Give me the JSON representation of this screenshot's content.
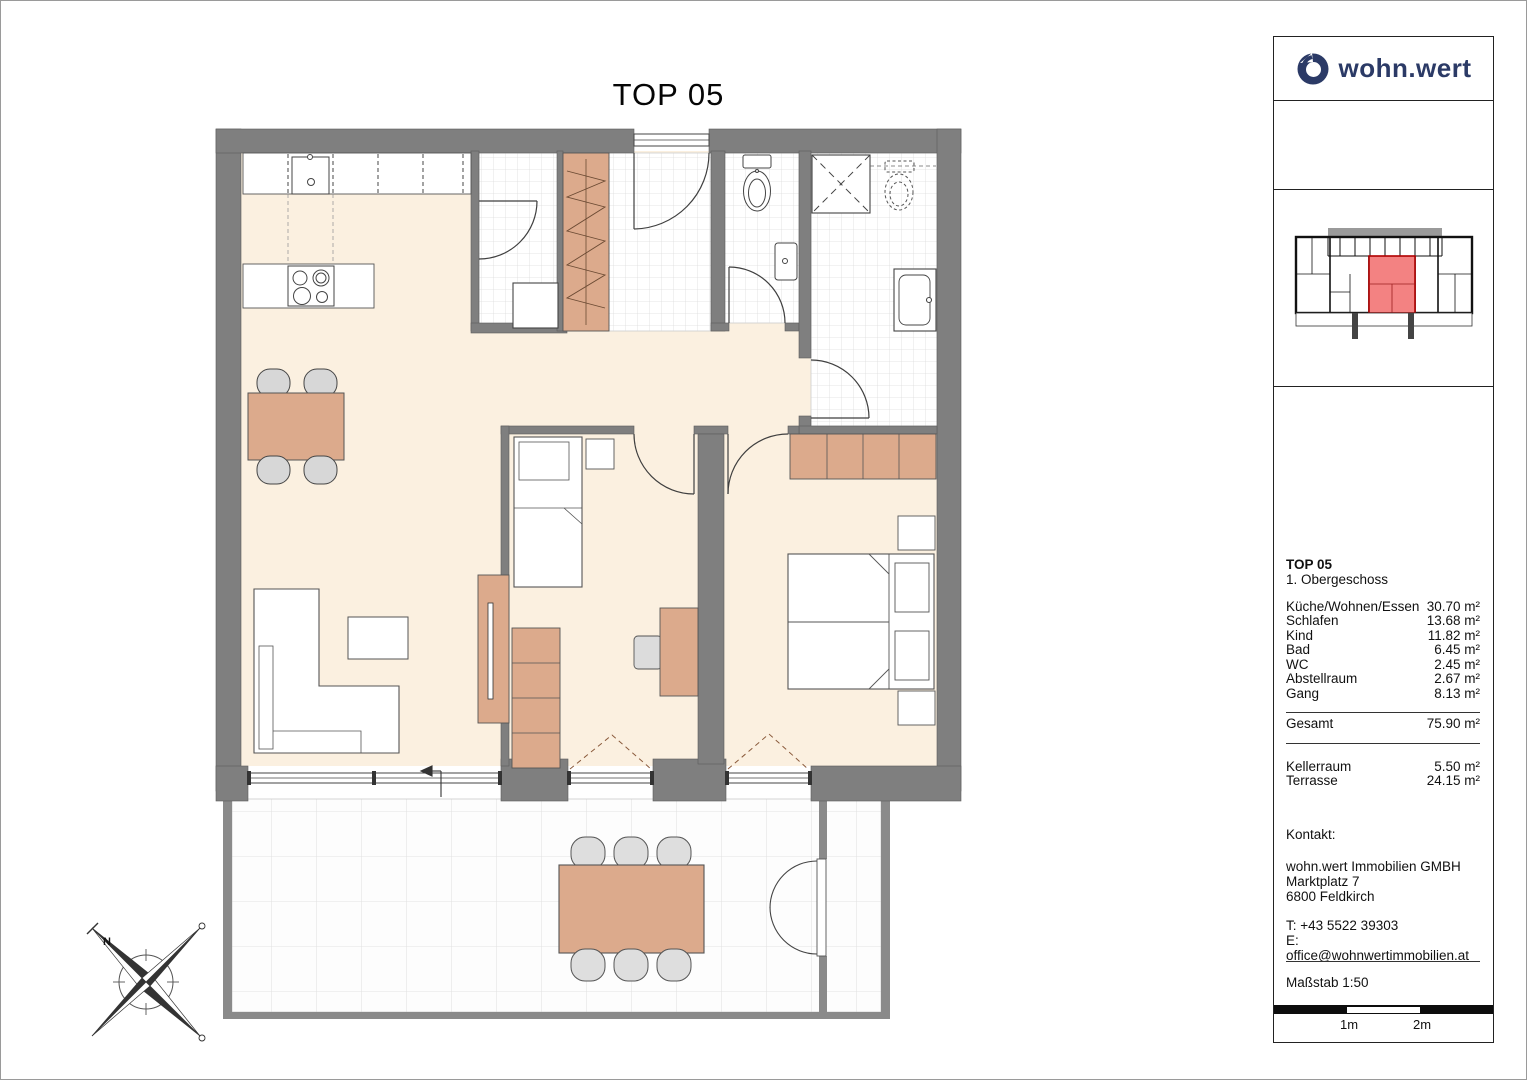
{
  "page": {
    "title": "TOP 05"
  },
  "sidebar": {
    "logo_text": "wohn.wert",
    "unit": {
      "title": "TOP 05",
      "floor": "1. Obergeschoss"
    },
    "rooms": [
      {
        "label": "Küche/Wohnen/Essen",
        "area": "30.70 m²"
      },
      {
        "label": "Schlafen",
        "area": "13.68 m²"
      },
      {
        "label": "Kind",
        "area": "11.82 m²"
      },
      {
        "label": "Bad",
        "area": "6.45 m²"
      },
      {
        "label": "WC",
        "area": "2.45 m²"
      },
      {
        "label": "Abstellraum",
        "area": "2.67 m²"
      },
      {
        "label": "Gang",
        "area": "8.13 m²"
      }
    ],
    "total": {
      "label": "Gesamt",
      "area": "75.90 m²"
    },
    "extras": [
      {
        "label": "Kellerraum",
        "area": "5.50 m²"
      },
      {
        "label": "Terrasse",
        "area": "24.15 m²"
      }
    ],
    "contact": {
      "heading": "Kontakt:",
      "company": "wohn.wert Immobilien GMBH",
      "street": "Marktplatz 7",
      "city": "6800 Feldkirch",
      "phone": "T: +43 5522 39303",
      "email": "E: office@wohnwertimmobilien.at"
    },
    "scale": {
      "label": "Maßstab 1:50",
      "marks": [
        "1m",
        "2m"
      ]
    }
  },
  "compass": {
    "north_label": "N"
  },
  "colors": {
    "wall_gray": "#7f7f7f",
    "floor_cream": "#fbf0e0",
    "wood_furniture": "#dcaa8c",
    "chair_gray": "#d7d7d7",
    "keyplan_highlight": "#f38282",
    "logo_navy": "#2b3a66"
  }
}
